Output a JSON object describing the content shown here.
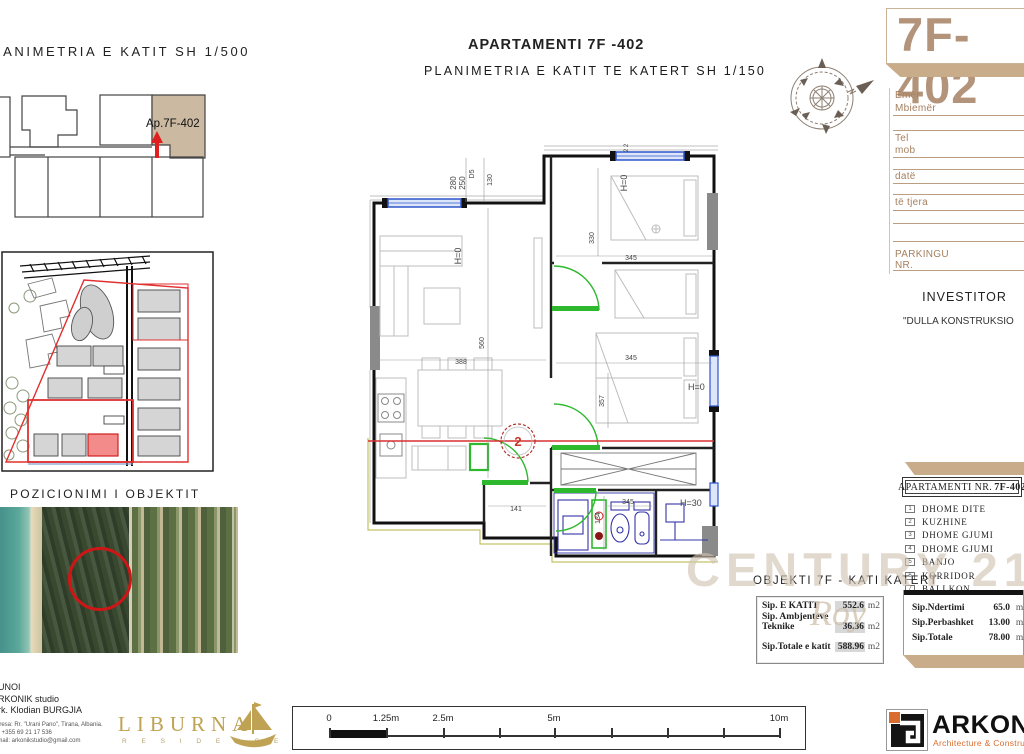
{
  "key_plan": {
    "title": "PLANIMETRIA E KATIT  SH 1/500",
    "unit_label": "Ap.7F-402"
  },
  "header": {
    "title": "APARTAMENTI 7F -402",
    "subtitle": "PLANIMETRIA E KATIT TE KATERT SH 1/150"
  },
  "title_card": {
    "code": "7F-402"
  },
  "contact_form": {
    "emer": "Emër",
    "mbiemer": "Mbiemër",
    "tel": "Tel",
    "mob": "mob",
    "date": "datë",
    "te_tjera": "të tjera",
    "parkingu": "PARKINGU",
    "nr": "NR."
  },
  "investor": {
    "label": "INVESTITOR",
    "name": "\"DULLA KONSTRUKSIO"
  },
  "position": {
    "title": "POZICIONIMI I OBJEKTIT"
  },
  "legend": {
    "header_normal": "APARTAMENTI  NR.",
    "header_bold": "7F-402",
    "rooms": [
      {
        "n": "1",
        "label": "DHOME DITE"
      },
      {
        "n": "2",
        "label": "KUZHINE"
      },
      {
        "n": "3",
        "label": "DHOME GJUMI"
      },
      {
        "n": "4",
        "label": "DHOME GJUMI"
      },
      {
        "n": "5",
        "label": "BANJO"
      },
      {
        "n": "6",
        "label": "KORRIDOR"
      },
      {
        "n": "7",
        "label": "BALLKON"
      }
    ]
  },
  "watermark": {
    "brand": "CENTURY 21.",
    "script": "Roy"
  },
  "object_line": "OBJEKTI 7F - KATI KATERT",
  "area_table_left": {
    "r1_label": "Sip. E KATIT",
    "r1_value": "552.6",
    "r2_label1": "Sip. Ambjenteve",
    "r2_label2": "Teknike",
    "r2_value": "36.36",
    "r3_label": "Sip.Totale e katit",
    "r3_value": "588.96",
    "unit": "m2"
  },
  "area_table_right": {
    "r1_label": "Sip.Ndertimi",
    "r1_value": "65.0",
    "r2_label": "Sip.Perbashket",
    "r2_value": "13.00",
    "r3_label": "Sip.Totale",
    "r3_value": "78.00",
    "unit": "m2"
  },
  "author_block": {
    "line1": "PUNOI",
    "line2": "ARKONIK studio",
    "line3": "Ark. Klodian BURGJIA",
    "small1": "Adresa: Rr. \"Urani Pano\", Tirana, Albania.",
    "small2": "tel. +355 69 21 17 536",
    "small3": "e-mail: arkonikstudio@gmail.com"
  },
  "liburna": {
    "name": "LIBURNA",
    "subtitle": "R E S I D E N C E"
  },
  "scalebar": {
    "labels": [
      "0",
      "1.25m",
      "2.5m",
      "5m",
      "10m"
    ]
  },
  "arkonik": {
    "name": "ARKONIK",
    "tagline": "Architecture & Construction"
  },
  "plan": {
    "dims": {
      "d280": "280",
      "d250": "250",
      "dD5": "D5",
      "d130": "130",
      "d560": "560",
      "d330": "330",
      "d345": "345",
      "d357": "357",
      "d388": "388",
      "d141": "141",
      "d134": "134",
      "d22": "2 2"
    },
    "labels": {
      "h0": "H=0",
      "h30": "H=30",
      "room2": "2"
    }
  },
  "colors": {
    "tan": "#b3947a",
    "bevel": "#c9ad8b",
    "form_brown": "#a5805f",
    "watermark": "#cfc2b0",
    "gold": "#bfa254",
    "orange": "#d96c2f",
    "wall": "#111111",
    "window_blue": "#2f55cc",
    "door_green": "#2eb82e",
    "red": "#d93030",
    "unit_fill": "#cbb9a2"
  }
}
